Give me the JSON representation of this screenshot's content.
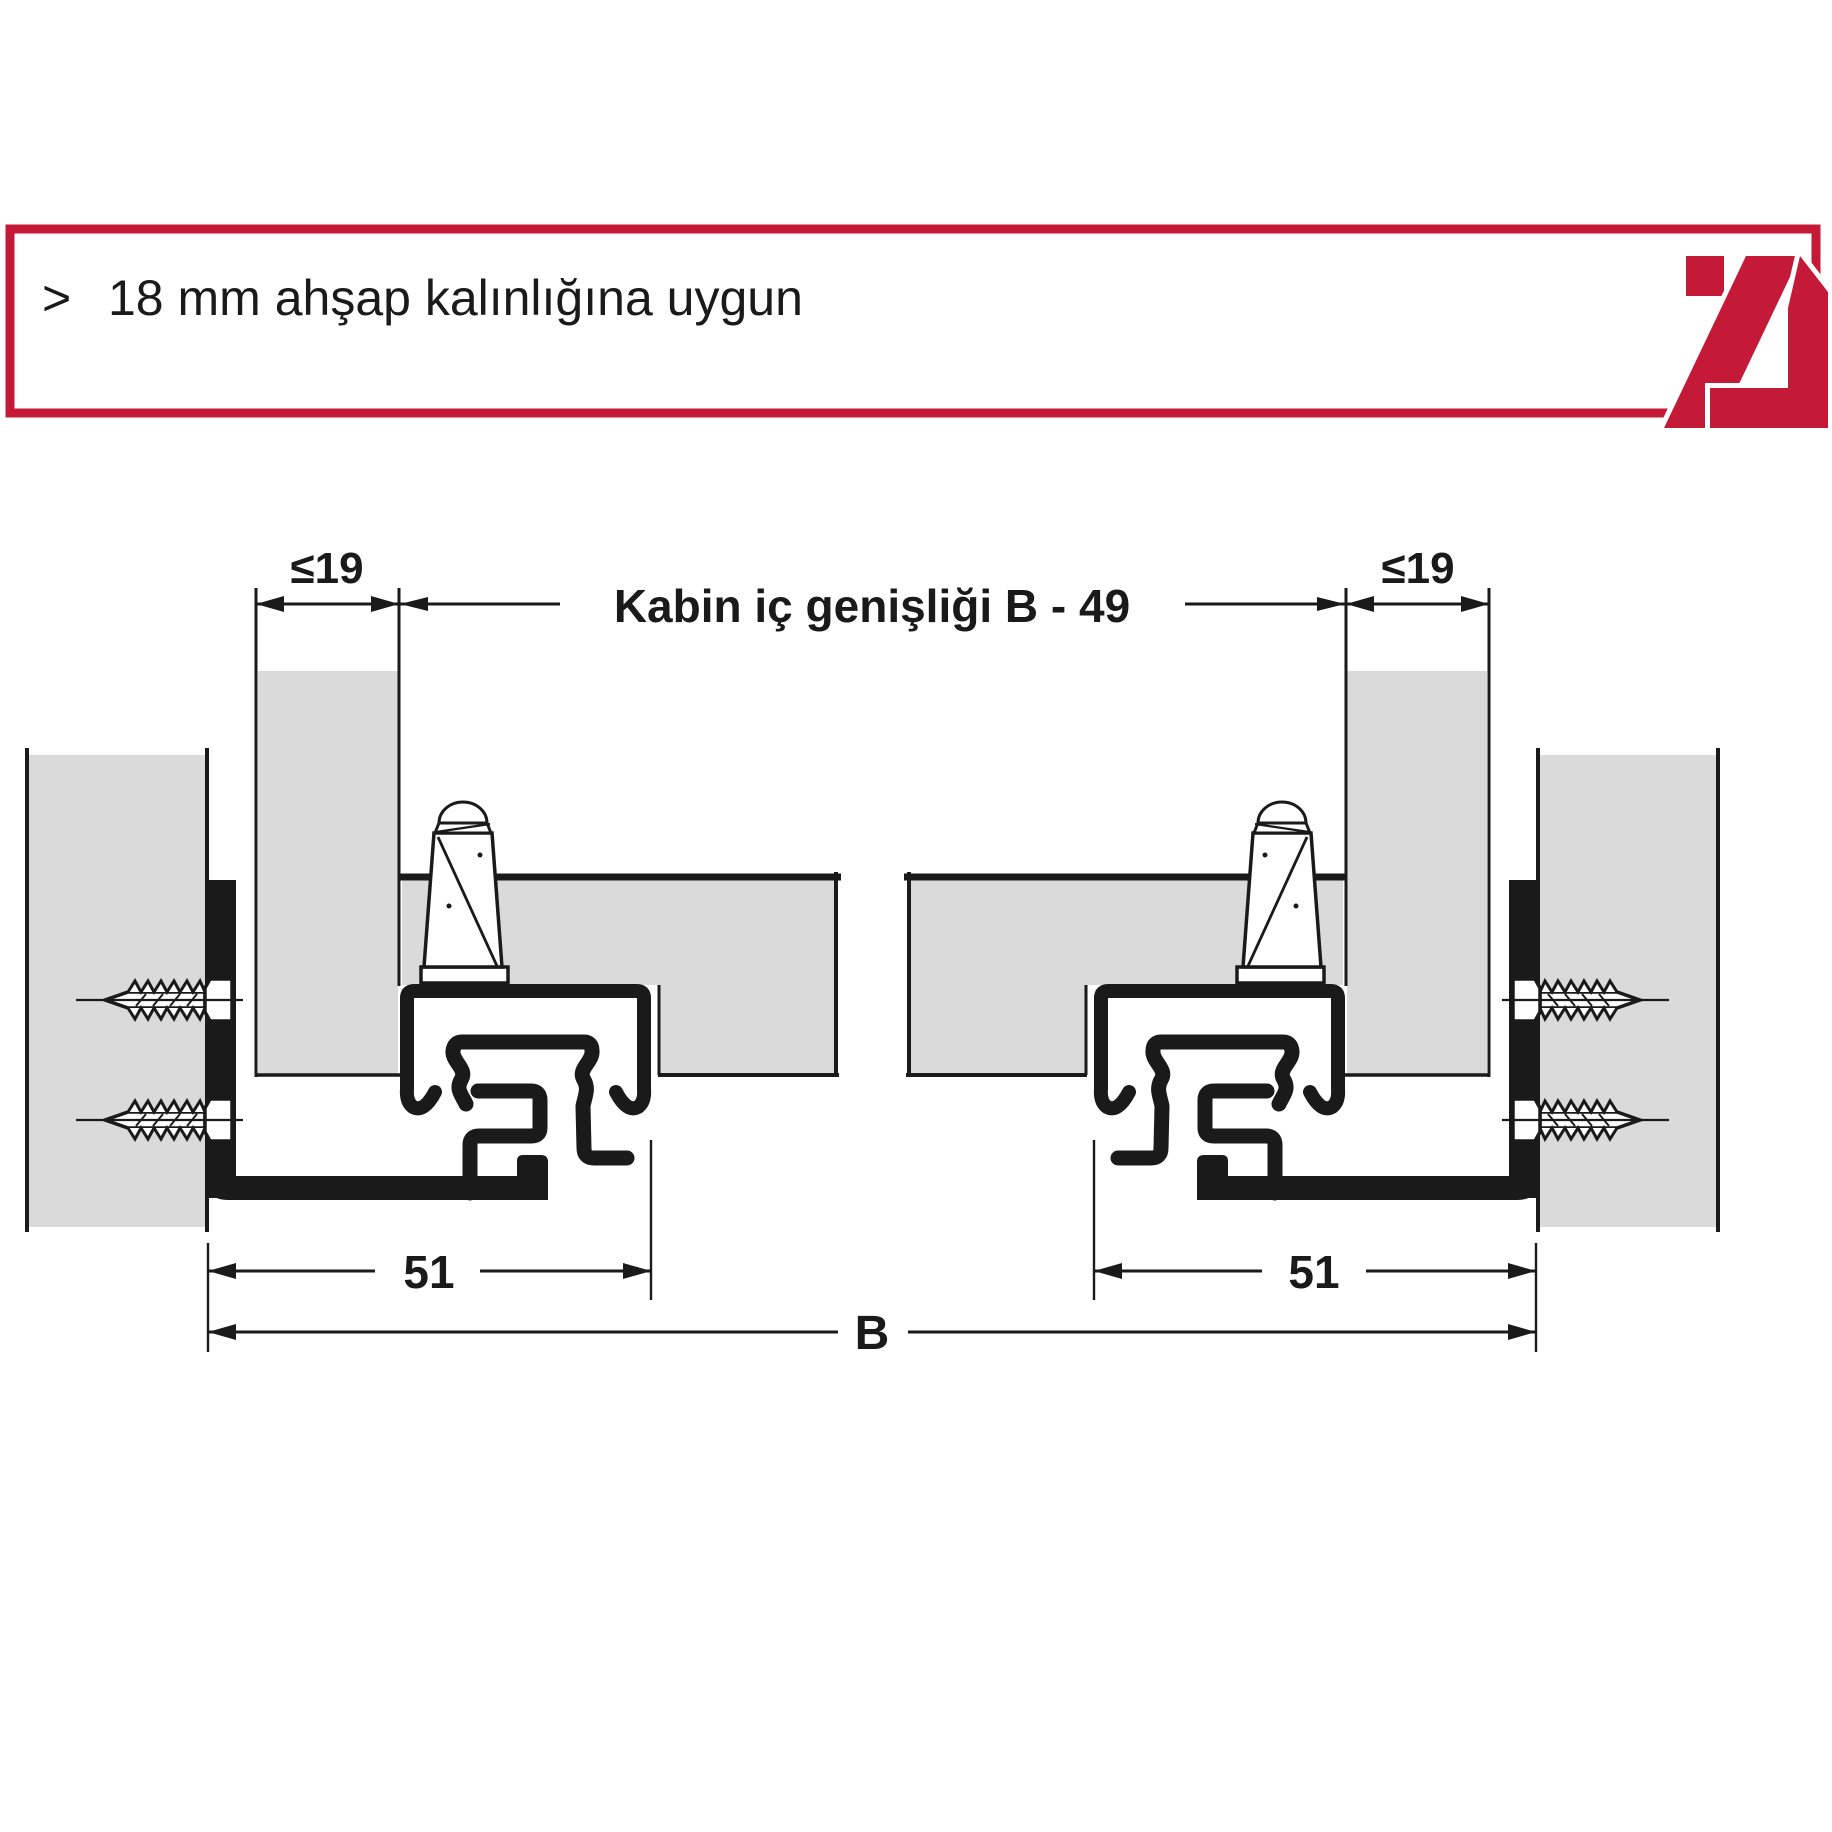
{
  "header": {
    "bullet": ">",
    "note": "18 mm ahşap kalınlığına uygun"
  },
  "diagram": {
    "dim_panel_thickness_left": "≤19",
    "dim_panel_thickness_right": "≤19",
    "dim_cabinet_inner_width": "Kabin iç genişliği B - 49",
    "dim_slide_offset_left": "51",
    "dim_slide_offset_right": "51",
    "dim_cabinet_width": "B"
  },
  "colors": {
    "accent_red": "#C41937",
    "panel_gray": "#DADADA",
    "ink": "#1A1A1A",
    "background": "#FFFFFF"
  }
}
